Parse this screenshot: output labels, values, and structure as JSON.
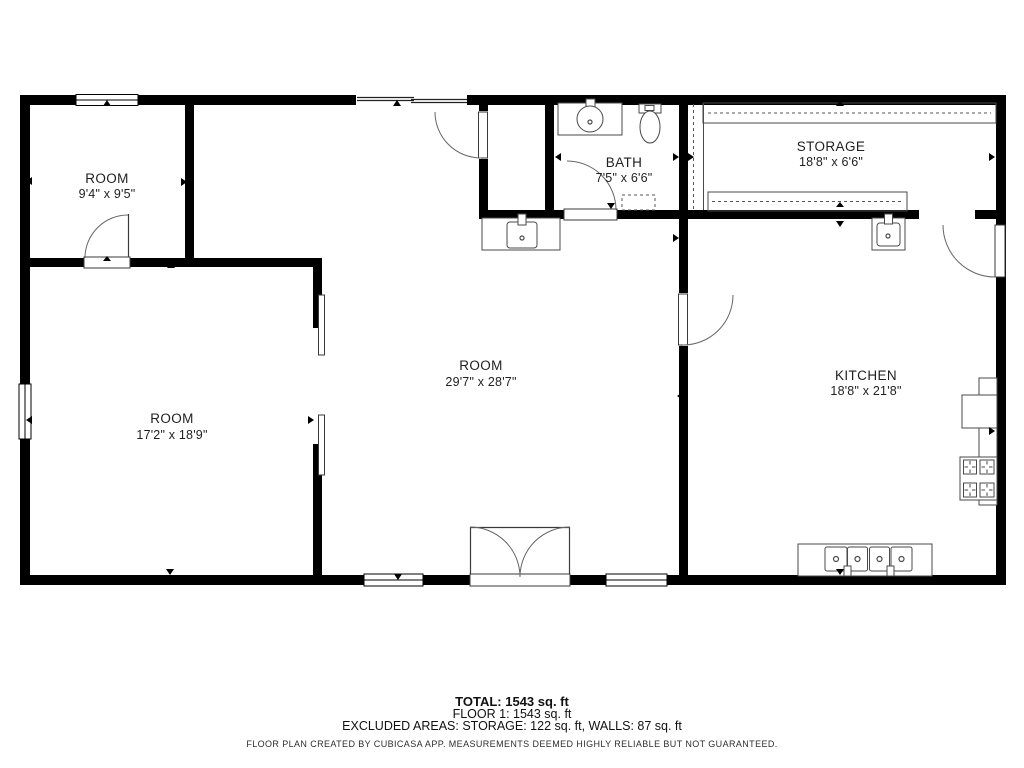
{
  "rooms": [
    {
      "name": "ROOM",
      "dims": "9'4\" x 9'5\""
    },
    {
      "name": "BATH",
      "dims": "7'5\" x 6'6\""
    },
    {
      "name": "STORAGE",
      "dims": "18'8\" x 6'6\""
    },
    {
      "name": "ROOM",
      "dims": "17'2\" x 18'9\""
    },
    {
      "name": "ROOM",
      "dims": "29'7\" x 28'7\""
    },
    {
      "name": "KITCHEN",
      "dims": "18'8\" x 21'8\""
    }
  ],
  "footer": {
    "total": "TOTAL: 1543 sq. ft",
    "floor1": "FLOOR 1: 1543 sq. ft",
    "excluded": "EXCLUDED AREAS: STORAGE: 122 sq. ft, WALLS: 87 sq. ft",
    "disclaimer": "FLOOR PLAN CREATED BY CUBICASA APP. MEASUREMENTS DEEMED HIGHLY RELIABLE BUT NOT GUARANTEED."
  },
  "colors": {
    "wall": "#000000",
    "background": "#ffffff",
    "fixture_line": "#4a4a4a",
    "text": "#1f1f1f"
  }
}
